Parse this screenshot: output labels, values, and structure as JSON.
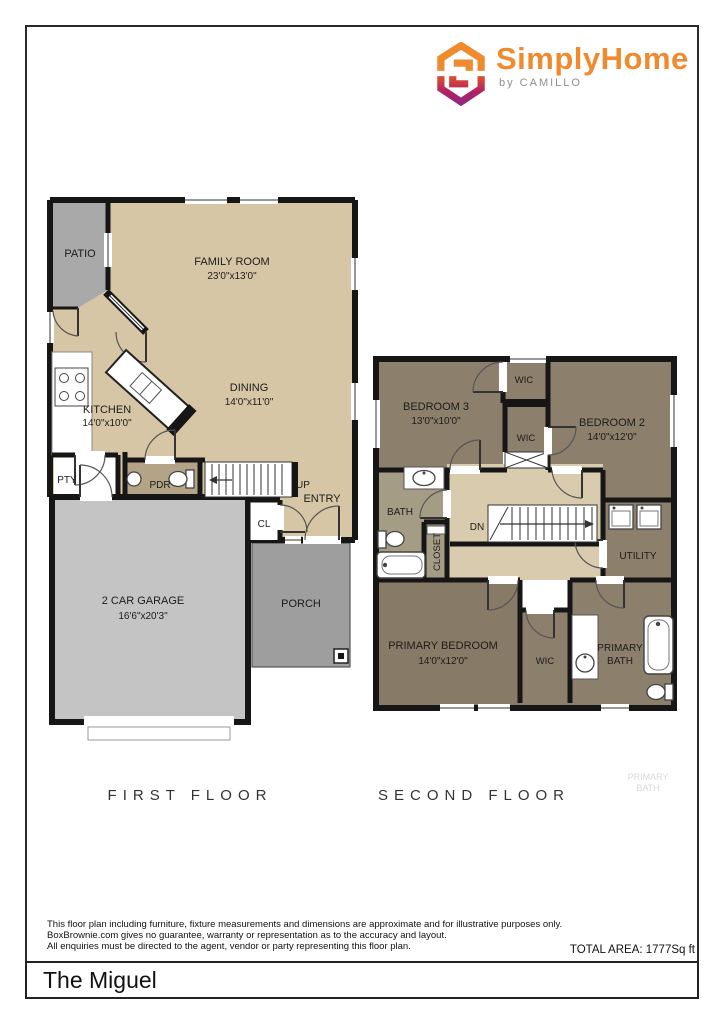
{
  "brand": {
    "name": "SimplyHome",
    "byline": "by CAMILLO",
    "orange": "#F08A2E",
    "magenta": "#B01F62"
  },
  "ff": {
    "caption": "FIRST FLOOR",
    "patio": "PATIO",
    "family": "FAMILY ROOM",
    "family_dims": "23'0\"x13'0\"",
    "kitchen": "KITCHEN",
    "kitchen_dims": "14'0\"x10'0\"",
    "dining": "DINING",
    "dining_dims": "14'0\"x11'0\"",
    "pty": "PTY",
    "pdr": "PDR",
    "up": "UP",
    "entry": "ENTRY",
    "cl": "CL",
    "garage": "2 CAR GARAGE",
    "garage_dims": "16'6\"x20'3\"",
    "porch": "PORCH"
  },
  "sf": {
    "caption": "SECOND FLOOR",
    "bedroom3": "BEDROOM 3",
    "bedroom3_dims": "13'0\"x10'0\"",
    "wic_top": "WIC",
    "bedroom2": "BEDROOM 2",
    "bedroom2_dims": "14'0\"x12'0\"",
    "wic_mid": "WIC",
    "bath": "BATH",
    "closet": "CLOSET",
    "dn": "DN",
    "utility": "UTILITY",
    "primary_bedroom": "PRIMARY BEDROOM",
    "primary_bedroom_dims": "14'0\"x12'0\"",
    "wic_bottom": "WIC",
    "primary_bath_line1": "PRIMARY",
    "primary_bath_line2": "BATH",
    "ghost_line1": "PRIMARY",
    "ghost_line2": "BATH"
  },
  "footer": {
    "disclaimer1": "This floor plan including furniture, fixture measurements and dimensions are approximate and for illustrative purposes only.",
    "disclaimer2": "BoxBrownie.com gives no guarantee, warranty or representation as to the accuracy and layout.",
    "disclaimer3": "All enquiries must be directed to the agent, vendor or party representing this floor plan.",
    "total_area": "TOTAL AREA: 1777Sq ft",
    "plan_name": "The Miguel"
  },
  "colors": {
    "wall": "#161616",
    "floor_tan": "#D6C6A5",
    "floor_brown": "#8C7F6C",
    "floor_olive": "#A59C85",
    "pdr_tan": "#B3A487",
    "patio_gray": "#A9A9A9",
    "garage_gray": "#C4C4C4",
    "porch_gray": "#9E9E9E"
  }
}
